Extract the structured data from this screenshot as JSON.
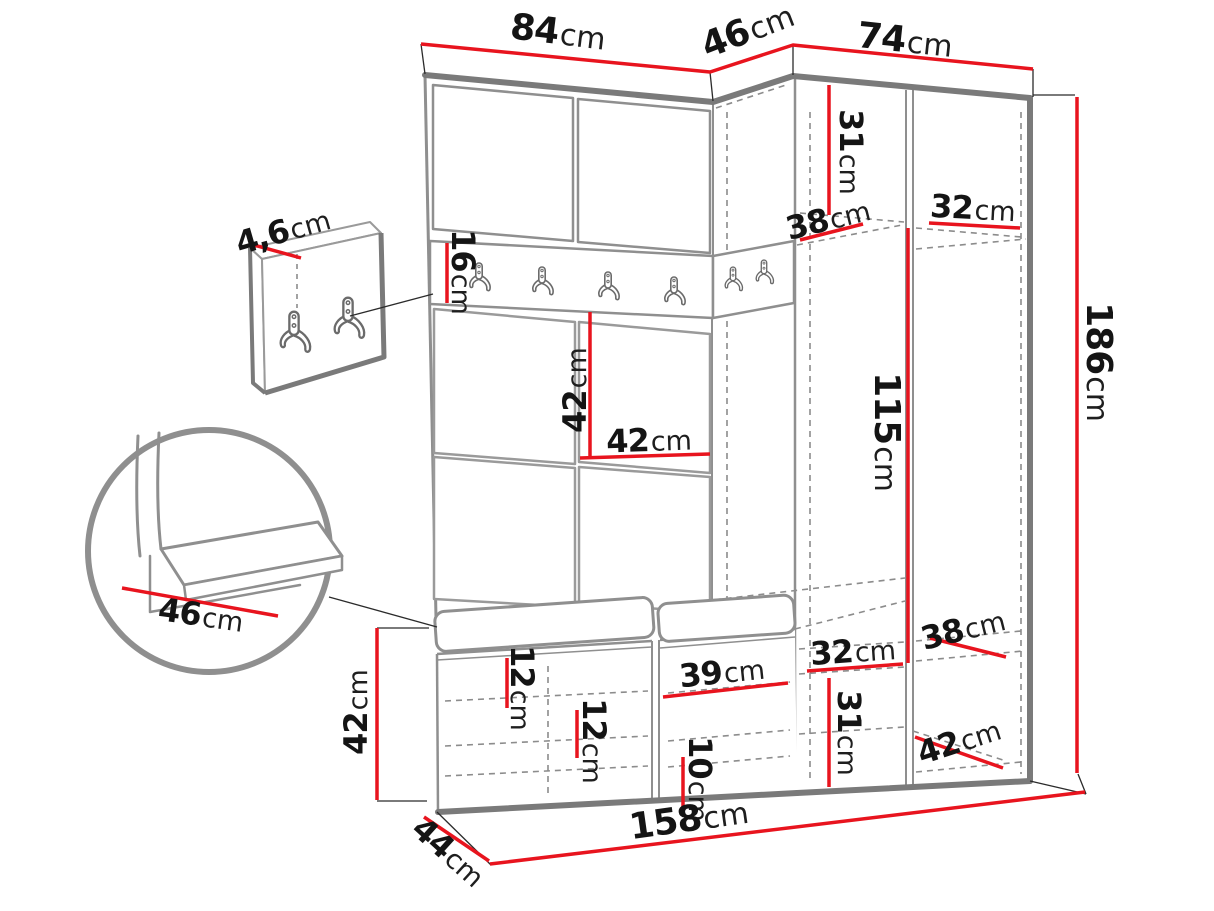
{
  "diagram": {
    "type": "furniture-dimension-diagram",
    "unit": "cm",
    "colors": {
      "dimension_red": "#e8141e",
      "outline_dark_gray": "#7a7a7a",
      "line_gray": "#8f8f8f",
      "dash_gray": "#8c8c8c",
      "text_black": "#141414"
    },
    "icons": [
      "coat-hook-icon"
    ]
  },
  "dims": [
    {
      "id": "top-width-left",
      "value": "84",
      "unit": "cm"
    },
    {
      "id": "top-depth-corner",
      "value": "46",
      "unit": "cm"
    },
    {
      "id": "top-width-right",
      "value": "74",
      "unit": "cm"
    },
    {
      "id": "upper-shelf-height",
      "value": "31",
      "unit": "cm"
    },
    {
      "id": "upper-shelf-depth",
      "value": "38",
      "unit": "cm"
    },
    {
      "id": "upper-shelf-width",
      "value": "32",
      "unit": "cm"
    },
    {
      "id": "hook-rail-height",
      "value": "16",
      "unit": "cm"
    },
    {
      "id": "back-panel-height",
      "value": "42",
      "unit": "cm"
    },
    {
      "id": "back-panel-width",
      "value": "42",
      "unit": "cm"
    },
    {
      "id": "hanging-section-height",
      "value": "115",
      "unit": "cm"
    },
    {
      "id": "total-height",
      "value": "186",
      "unit": "cm"
    },
    {
      "id": "lower-shelf-depth",
      "value": "38",
      "unit": "cm"
    },
    {
      "id": "lower-shelf-width",
      "value": "32",
      "unit": "cm"
    },
    {
      "id": "lower-compartment-height",
      "value": "31",
      "unit": "cm"
    },
    {
      "id": "lower-right-shelf-depth",
      "value": "42",
      "unit": "cm"
    },
    {
      "id": "bench-top-offset",
      "value": "12",
      "unit": "cm"
    },
    {
      "id": "bench-shelf-gap",
      "value": "12",
      "unit": "cm"
    },
    {
      "id": "bench-compartment-width",
      "value": "39",
      "unit": "cm"
    },
    {
      "id": "bench-bottom-shelf-height",
      "value": "10",
      "unit": "cm"
    },
    {
      "id": "total-width",
      "value": "158",
      "unit": "cm"
    },
    {
      "id": "bench-depth",
      "value": "44",
      "unit": "cm"
    },
    {
      "id": "bench-height",
      "value": "42",
      "unit": "cm"
    },
    {
      "id": "seat-depth",
      "value": "46",
      "unit": "cm"
    },
    {
      "id": "hook-panel-thickness",
      "value": "4,6",
      "unit": "cm"
    }
  ]
}
